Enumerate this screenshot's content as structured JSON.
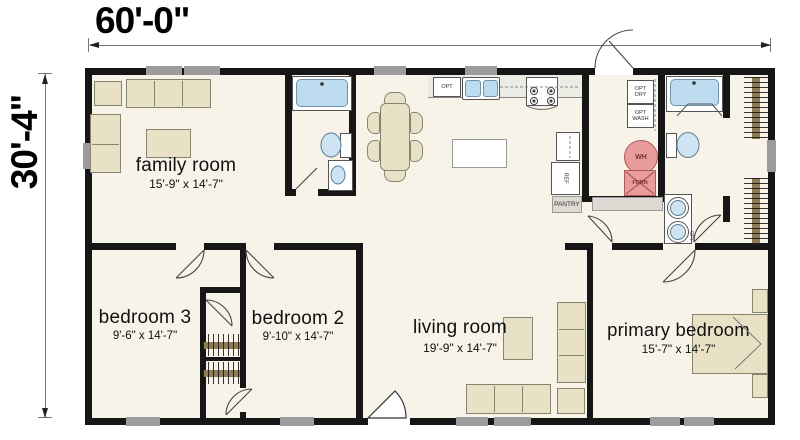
{
  "dimensions": {
    "width": "60'-0\"",
    "height": "30'-4\""
  },
  "rooms": [
    {
      "name": "family room",
      "size": "15'-9\" x 14'-7\""
    },
    {
      "name": "bedroom 3",
      "size": "9'-6\" x 14'-7\""
    },
    {
      "name": "bedroom 2",
      "size": "9'-10\" x 14'-7\""
    },
    {
      "name": "living room",
      "size": "19'-9\" x 14'-7\""
    },
    {
      "name": "primary bedroom",
      "size": "15'-7\" x 14'-7\""
    }
  ],
  "labels": {
    "opt_dishwasher": "OPT",
    "opt_dryer": "OPT\nDRY",
    "opt_washer": "OPT\nWASH",
    "water_heater": "WH",
    "furnace": "FURN",
    "pantry": "PANTRY",
    "refrigerator": "REF",
    "opt_vanity": "OPT"
  },
  "colors": {
    "wall": "#161616",
    "floor": "#f7f3e9",
    "furniture": "#e9e1c6",
    "fixture_blue": "#bedcf0",
    "mechanical_pink": "#e89c9c",
    "window_gray": "#9c9c9c"
  }
}
